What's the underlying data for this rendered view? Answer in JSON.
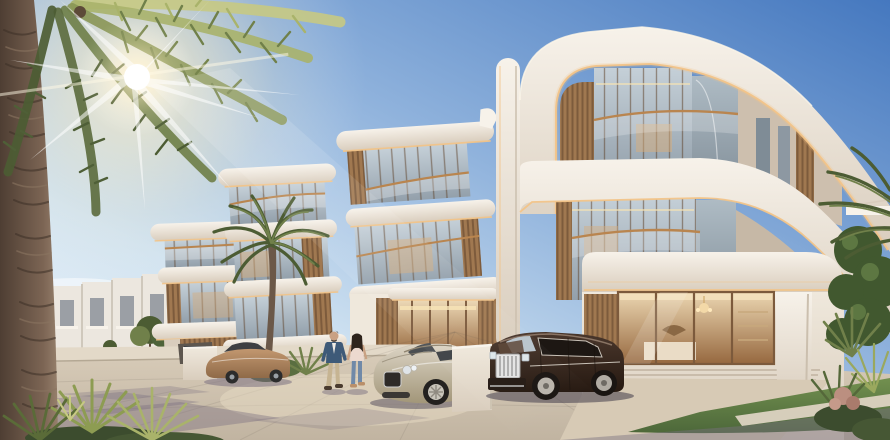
{
  "scene": {
    "alt_text": "Sunlit render of a luxury villa community: three-storey white villas with curved cantilevered balconies, bronze-framed glass and timber slats; palm trees; a couple walking; a champagne grand-tourer coupe, a bronze sedan and a dark Rolls-Royce-style SUV parked on a stone driveway.",
    "objects": {
      "sun": "sun with rays through palm fronds",
      "palm_left": "large foreground palm tree",
      "palm_mid": "palm tree in front of villas",
      "townhouses": "distant white townhouse row",
      "villa_left": "left villa cluster",
      "villa_middle": "middle villa with entrance lobby",
      "villa_main": "main villa with curved roof bands",
      "display_window": "ground-floor interior window with chandelier",
      "bentley": "champagne luxury coupe",
      "rolls": "dark luxury SUV",
      "sedan": "bronze sedan",
      "wall": "white privacy wall",
      "man": "man in navy blazer",
      "woman": "woman in blush top and jeans",
      "lawn": "lawn and landscaping"
    }
  },
  "palette": {
    "sky_top": "#4578bf",
    "sky_mid": "#8fb2dc",
    "sky_low": "#cfe2f1",
    "sky_horizon": "#eaf2f8",
    "sun_core": "#ffffff",
    "sun_glow": "#ffefc4",
    "white_hi": "#f7f2ea",
    "white_mid": "#efe8dc",
    "white_shade": "#d9cdbd",
    "led": "#f2c489",
    "wood": "#a07850",
    "wood_dark": "#7c5a3c",
    "glass_hi": "#c5d0d8",
    "glass_lo": "#93a0ab",
    "glass_side_hi": "#aebbc4",
    "glass_side_lo": "#86939d",
    "interior_warm": "#d8ae7c",
    "interior_deep": "#96683f",
    "bronze": "#b9854f",
    "townhouse": "#ece7df",
    "townhouse_shadow": "#cfc8bc",
    "window_dark": "#8e939b",
    "pavement_hi": "#d9cdba",
    "pavement_lo": "#c1b4a1",
    "sidewalk": "#e3d9c8",
    "shadow_cool": "#7b7181",
    "lawn_hi": "#72904f",
    "lawn_lo": "#4d683a",
    "leaf_dark": "#4c5c33",
    "leaf_mid": "#70804a",
    "leaf_light": "#a9b36a",
    "leaf_sun": "#c6c983",
    "trunk_lit": "#7c6554",
    "trunk_shadow": "#4e3e33",
    "sedan_body": "#b18a66",
    "car_dark": "#5d564e",
    "bentley_hi": "#ddd5c6",
    "bentley_lo": "#a29679",
    "rolls_hi": "#4a372c",
    "rolls_lo": "#261911",
    "chrome": "#e4e4e4",
    "skin": "#c9a183",
    "hair": "#2e241c",
    "jacket": "#3e5a78",
    "pants": "#c6b492",
    "top_blush": "#ecd9cf",
    "jeans": "#7089a8"
  }
}
